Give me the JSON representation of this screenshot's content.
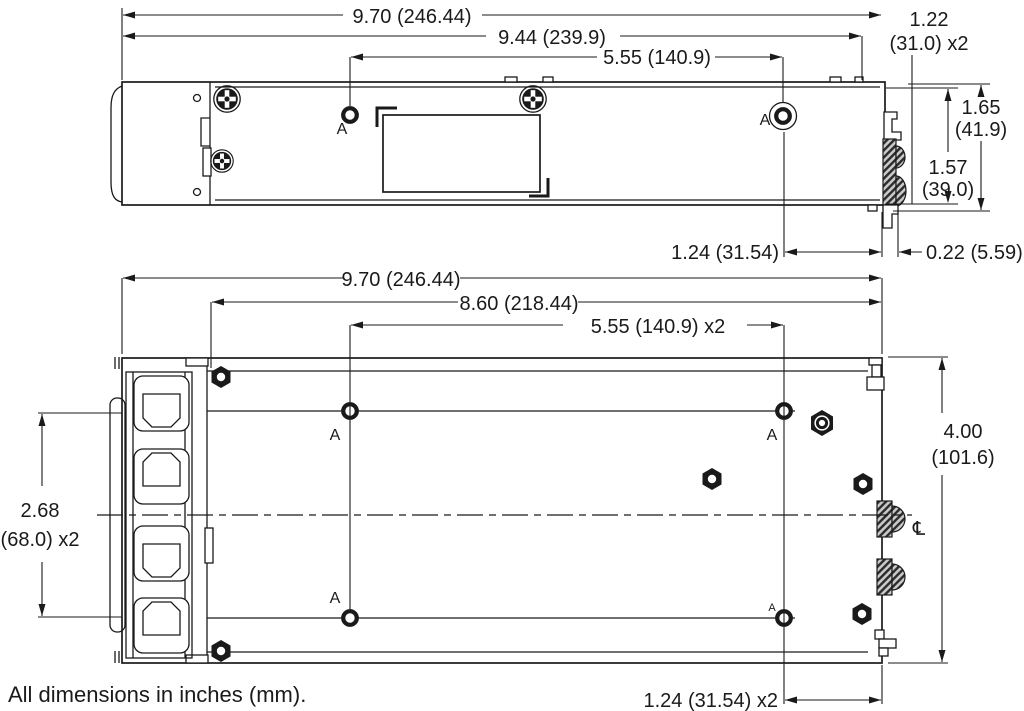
{
  "note": "All dimensions in inches (mm).",
  "colors": {
    "ink": "#1a1a1a",
    "background": "#ffffff",
    "hatch_fill": "#2b2b2b"
  },
  "side_view": {
    "dim_overall_width": "9.70 (246.44)",
    "dim_slot_span": "9.44 (239.9)",
    "dim_hole_span": "5.55 (140.9)",
    "dim_1_22_line1": "1.22",
    "dim_1_22_line2": "(31.0) x2",
    "dim_height_overall_line1": "1.65",
    "dim_height_overall_line2": "(41.9)",
    "dim_height_body_line1": "1.57",
    "dim_height_body_line2": "(39.0)",
    "dim_hole_to_edge": "1.24 (31.54)",
    "dim_protrusion": "0.22 (5.59)",
    "hole_label_left": "A",
    "hole_label_right": "A"
  },
  "plan_view": {
    "dim_overall_width": "9.70 (246.44)",
    "dim_8_60": "8.60 (218.44)",
    "dim_hole_span": "5.55 (140.9) x2",
    "dim_hole_pitch_line1": "2.68",
    "dim_hole_pitch_line2": "(68.0) x2",
    "dim_depth_line1": "4.00",
    "dim_depth_line2": "(101.6)",
    "dim_hole_to_edge": "1.24 (31.54) x2",
    "hole_label_top_left": "A",
    "hole_label_top_right": "A",
    "hole_label_bottom_left": "A",
    "hole_label_bottom_right": "A",
    "centerline_symbol": "℄"
  }
}
